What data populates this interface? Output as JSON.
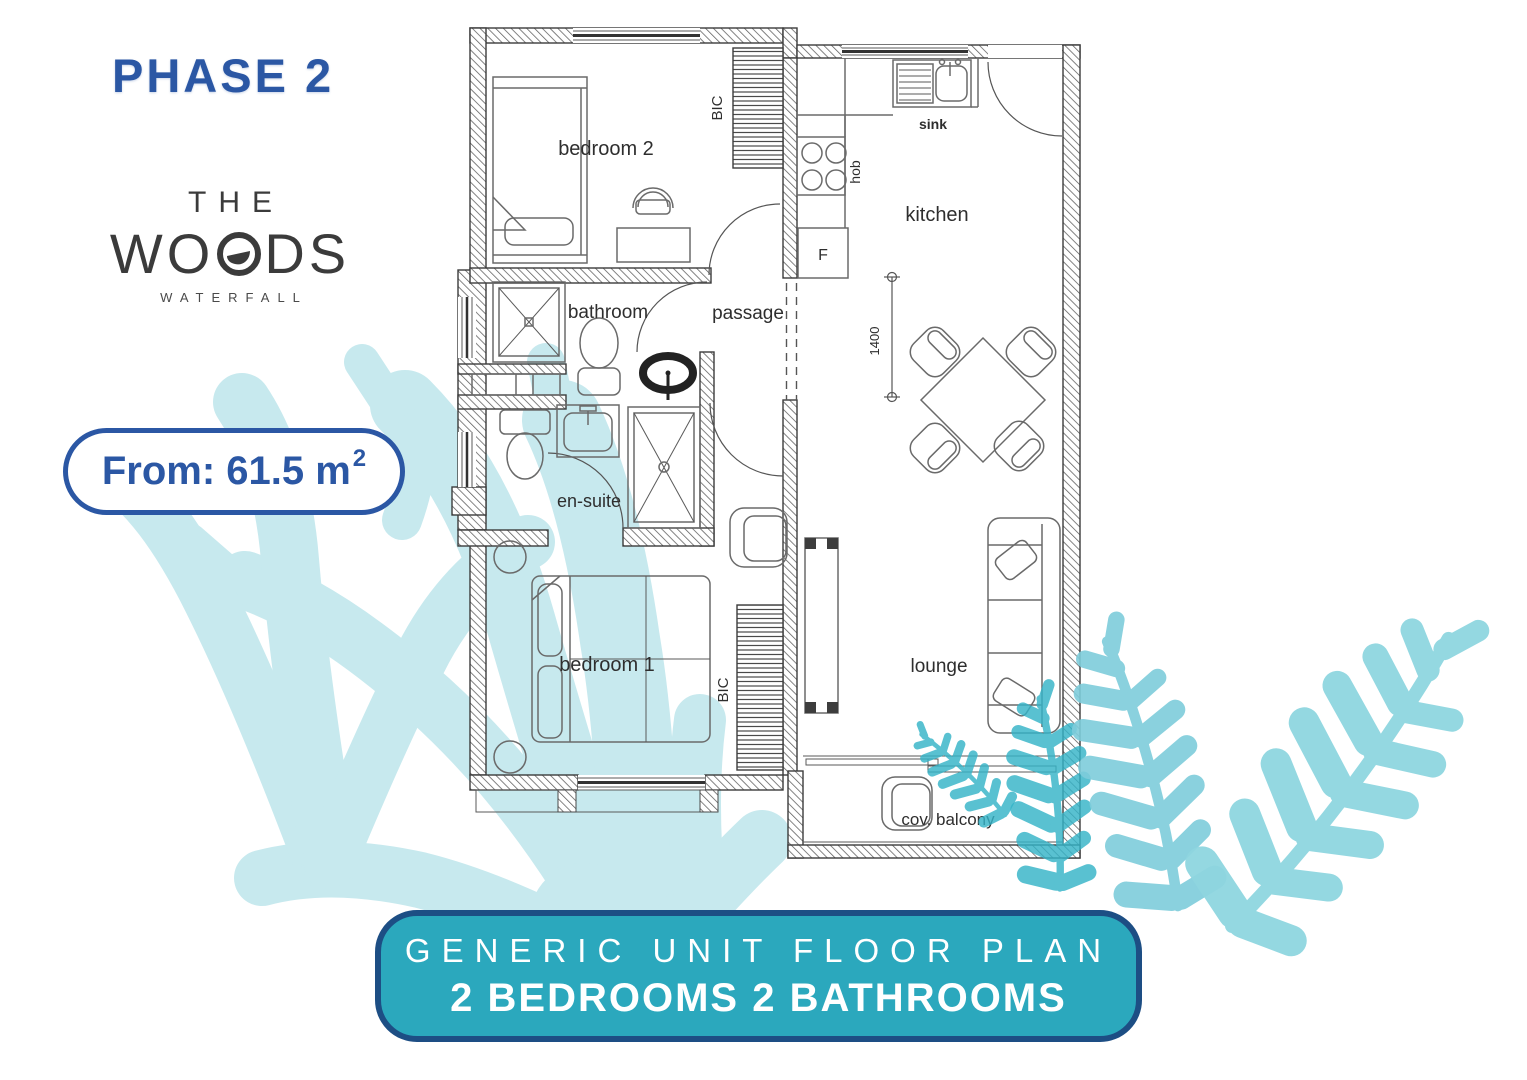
{
  "title": {
    "phase": "PHASE 2"
  },
  "logo": {
    "the": "THE",
    "woods_start": "WO",
    "woods_end": "DS",
    "waterfall": "WATERFALL"
  },
  "area_pill": {
    "label": "From: 61.5 m",
    "sup": "2"
  },
  "plan": {
    "labels": {
      "bedroom2": "bedroom 2",
      "bedroom1": "bedroom 1",
      "bathroom": "bathroom",
      "ensuite": "en-suite",
      "passage": "passage",
      "kitchen": "kitchen",
      "lounge": "lounge",
      "balcony": "cov. balcony",
      "sink": "sink",
      "hob": "hob",
      "fridge": "F",
      "bic": "BIC",
      "dim_1400": "1400"
    }
  },
  "banner": {
    "line1": "GENERIC UNIT FLOOR PLAN",
    "line2": "2 BEDROOMS 2 BATHROOMS"
  },
  "colors": {
    "accent_blue": "#2b57a4",
    "banner_teal": "#2ba8bd",
    "banner_border": "#1d4e84",
    "watermark_pale_teal": "#c7e9ee",
    "fern_teal": "#35b4c8",
    "fern_light_teal": "#8fd6e0",
    "logo_gray": "#3b3b3b",
    "plan_line_gray": "#4a4a4a"
  }
}
